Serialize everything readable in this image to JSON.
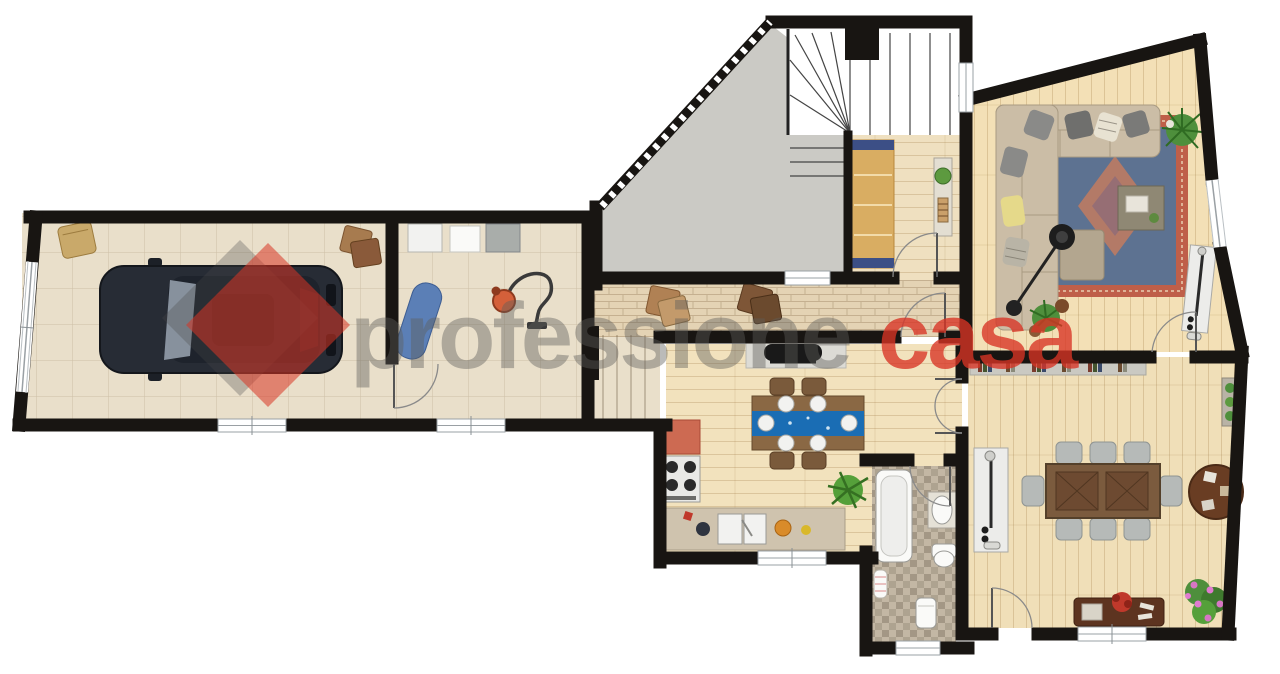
{
  "watermark": {
    "text_primary": "professione",
    "text_accent": "casa",
    "primary_color": "#5f5e5b",
    "accent_color": "#d93425",
    "primary_opacity": "0.42",
    "accent_opacity": "0.78",
    "diamond_shadow_color": "#4a4a4a"
  },
  "palette": {
    "wall": "#181512",
    "tile_floor": "#e9dfca",
    "corridor_floor": "#e4d3b4",
    "hallway_floor": "#efe0c0",
    "concrete": "#cbcac5",
    "stair": "#ffffff",
    "living_floor": "#f3e0b6",
    "kitchen_floor": "#f2e2bd",
    "dining_floor": "#f0dfb8",
    "bath_floor": "#c3b7a4",
    "rug_border": "#bf5f49",
    "rug_center": "#5d7291",
    "table_runner": "#1a6db4",
    "sofa": "#cbbda6",
    "car_body": "#272c35",
    "counter_red": "#cd6a52",
    "window_line": "#9aa0a4",
    "door_arc": "#8a8a8a"
  },
  "icons": [
    "car-icon",
    "garage-door-icon",
    "firewood-icon",
    "storage-bag-icon",
    "washing-machine-icon",
    "dryer-icon",
    "laundry-basket-icon",
    "ironing-board-icon",
    "vacuum-cleaner-icon",
    "staircase-icon",
    "wardrobe-icon",
    "console-table-icon",
    "fireplace-icon",
    "sofa-icon",
    "rug-icon",
    "coffee-table-icon",
    "ottoman-icon",
    "floor-lamp-icon",
    "plant-icon",
    "radiator-icon",
    "bookshelf-icon",
    "kitchen-table-icon",
    "chair-icon",
    "stove-icon",
    "kitchen-counter-icon",
    "sink-icon",
    "bathtub-icon",
    "washbasin-icon",
    "toilet-icon",
    "bidet-icon",
    "towel-icon",
    "dining-table-icon",
    "round-table-icon",
    "sideboard-icon",
    "flower-plant-icon",
    "window-icon",
    "door-icon"
  ]
}
